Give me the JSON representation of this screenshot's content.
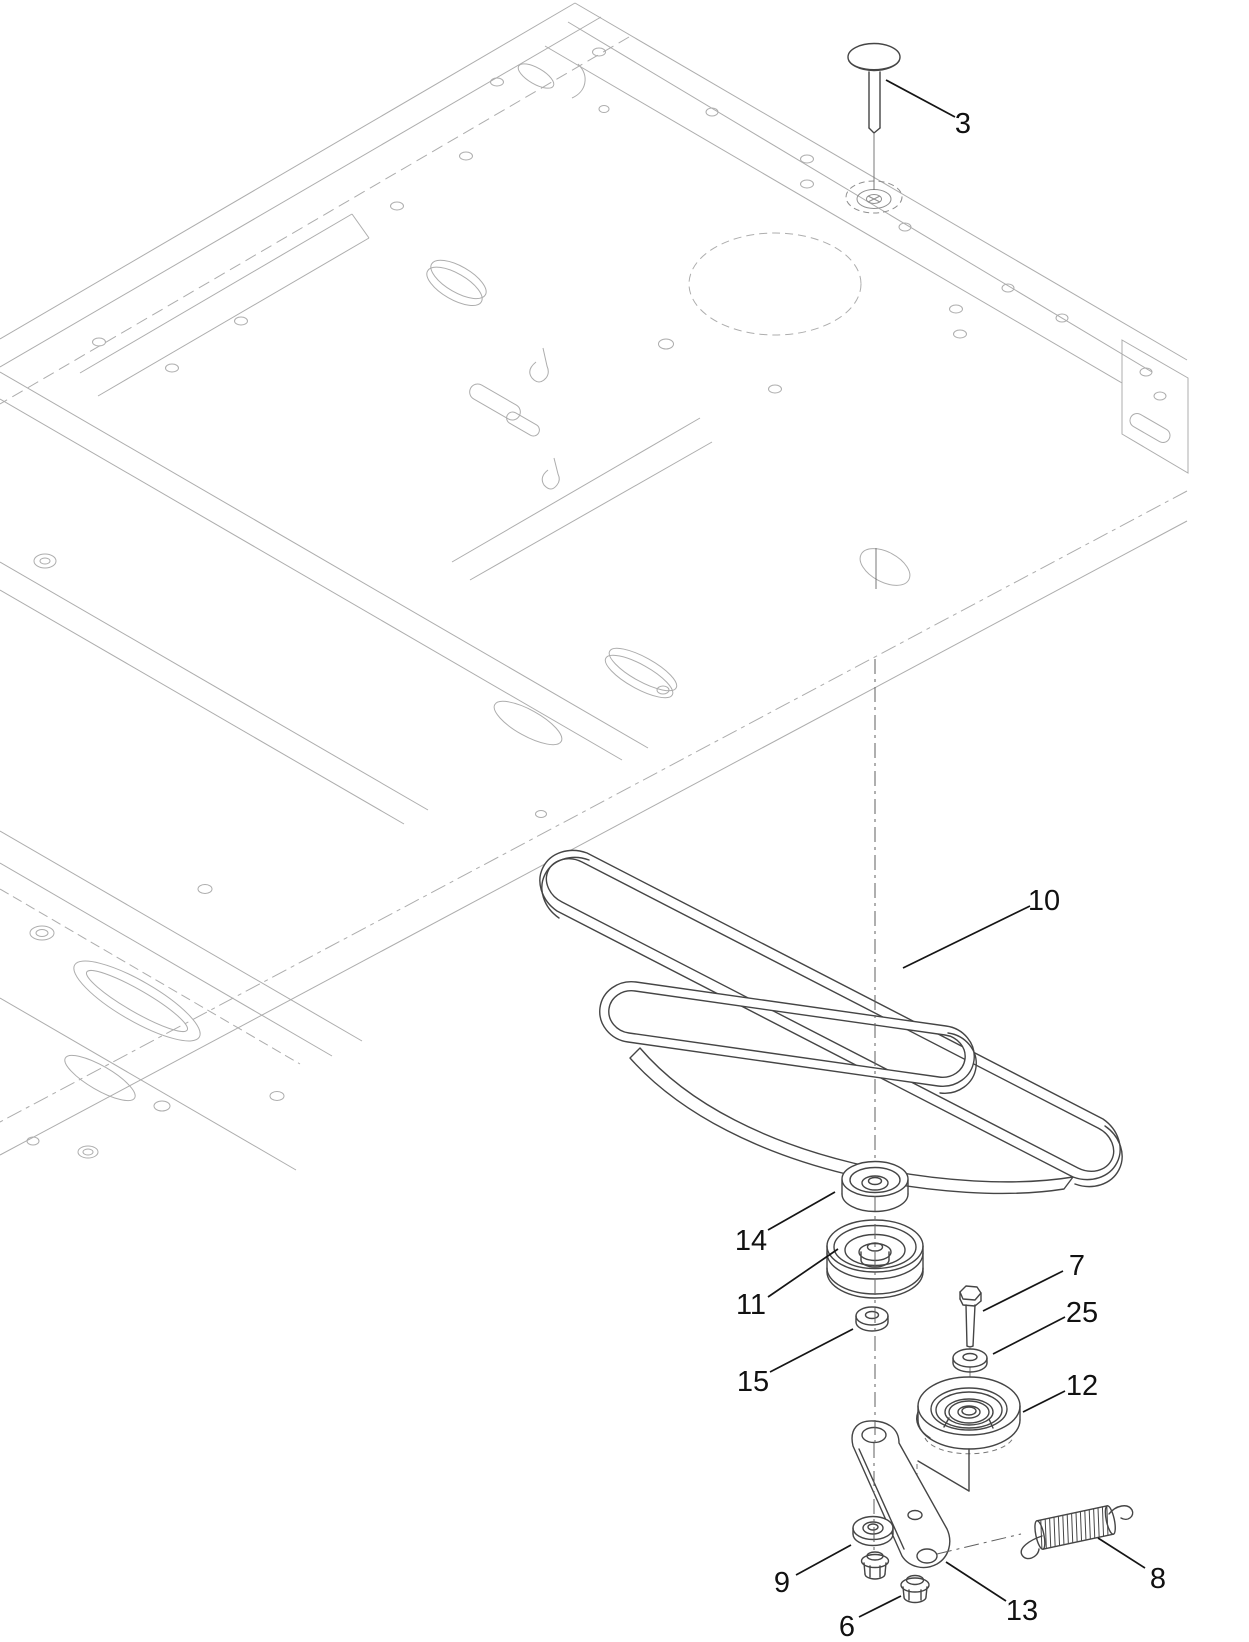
{
  "figure": {
    "kind": "exploded-parts-diagram",
    "background": "#ffffff",
    "canvas": {
      "width": 1249,
      "height": 1642
    },
    "colors": {
      "frame_lines": "#adadad",
      "part_lines": "#454545",
      "callout_ink": "#111111"
    },
    "callouts": [
      {
        "num": "3",
        "part": "carriage-bolt",
        "label_x": 963,
        "label_y": 133,
        "leader": [
          955,
          117,
          886,
          80
        ]
      },
      {
        "num": "10",
        "part": "v-belt",
        "label_x": 1044,
        "label_y": 910,
        "leader": [
          1030,
          906,
          903,
          968
        ]
      },
      {
        "num": "14",
        "part": "spacer",
        "label_x": 751,
        "label_y": 1250,
        "leader": [
          768,
          1230,
          835,
          1192
        ]
      },
      {
        "num": "11",
        "part": "v-idler-pulley",
        "label_x": 751,
        "label_y": 1314,
        "leader": [
          768,
          1297,
          838,
          1249
        ]
      },
      {
        "num": "15",
        "part": "washer-15",
        "label_x": 753,
        "label_y": 1391,
        "leader": [
          770,
          1372,
          853,
          1329
        ]
      },
      {
        "num": "7",
        "part": "hex-bolt",
        "label_x": 1077,
        "label_y": 1275,
        "leader": [
          1063,
          1271,
          983,
          1311
        ]
      },
      {
        "num": "25",
        "part": "washer-25",
        "label_x": 1082,
        "label_y": 1322,
        "leader": [
          1065,
          1317,
          993,
          1354
        ]
      },
      {
        "num": "12",
        "part": "flat-idler-pulley",
        "label_x": 1082,
        "label_y": 1395,
        "leader": [
          1065,
          1391,
          1023,
          1412
        ]
      },
      {
        "num": "9",
        "part": "washer-9",
        "label_x": 782,
        "label_y": 1592,
        "leader": [
          796,
          1575,
          851,
          1545
        ]
      },
      {
        "num": "6",
        "part": "flange-nut",
        "label_x": 847,
        "label_y": 1636,
        "leader": [
          859,
          1617,
          901,
          1596
        ]
      },
      {
        "num": "13",
        "part": "idler-arm",
        "label_x": 1022,
        "label_y": 1620,
        "leader": [
          1006,
          1601,
          946,
          1562
        ]
      },
      {
        "num": "8",
        "part": "extension-spring",
        "label_x": 1158,
        "label_y": 1588,
        "leader": [
          1145,
          1568,
          1098,
          1538
        ]
      }
    ]
  }
}
